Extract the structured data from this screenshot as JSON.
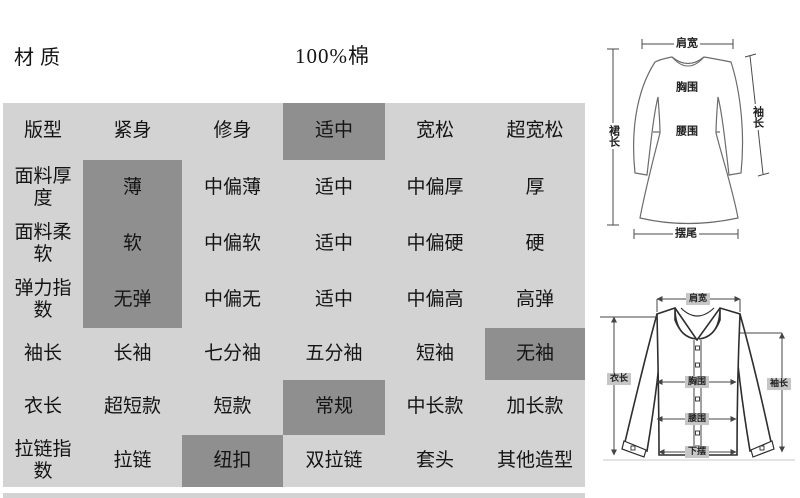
{
  "header": {
    "material_label": "材质",
    "material_value": "100%棉"
  },
  "colors": {
    "table_bg": "#d3d3d3",
    "selected_bg": "#8f8f8f",
    "text": "#141414",
    "chip_bg": "#c6c6c6"
  },
  "table": {
    "rows": [
      {
        "label": "版型",
        "options": [
          {
            "text": "紧身",
            "selected": false
          },
          {
            "text": "修身",
            "selected": false
          },
          {
            "text": "适中",
            "selected": true
          },
          {
            "text": "宽松",
            "selected": false
          },
          {
            "text": "超宽松",
            "selected": false
          }
        ]
      },
      {
        "label": "面料厚度",
        "options": [
          {
            "text": "薄",
            "selected": true
          },
          {
            "text": "中偏薄",
            "selected": false
          },
          {
            "text": "适中",
            "selected": false
          },
          {
            "text": "中偏厚",
            "selected": false
          },
          {
            "text": "厚",
            "selected": false
          }
        ]
      },
      {
        "label": "面料柔软",
        "options": [
          {
            "text": "软",
            "selected": true
          },
          {
            "text": "中偏软",
            "selected": false
          },
          {
            "text": "适中",
            "selected": false
          },
          {
            "text": "中偏硬",
            "selected": false
          },
          {
            "text": "硬",
            "selected": false
          }
        ]
      },
      {
        "label": "弹力指数",
        "options": [
          {
            "text": "无弹",
            "selected": true
          },
          {
            "text": "中偏无",
            "selected": false
          },
          {
            "text": "适中",
            "selected": false
          },
          {
            "text": "中偏高",
            "selected": false
          },
          {
            "text": "高弹",
            "selected": false
          }
        ]
      },
      {
        "label": "袖长",
        "options": [
          {
            "text": "长袖",
            "selected": false
          },
          {
            "text": "七分袖",
            "selected": false
          },
          {
            "text": "五分袖",
            "selected": false
          },
          {
            "text": "短袖",
            "selected": false
          },
          {
            "text": "无袖",
            "selected": true
          }
        ]
      },
      {
        "label": "衣长",
        "options": [
          {
            "text": "超短款",
            "selected": false
          },
          {
            "text": "短款",
            "selected": false
          },
          {
            "text": "常规",
            "selected": true
          },
          {
            "text": "中长款",
            "selected": false
          },
          {
            "text": "加长款",
            "selected": false
          }
        ]
      },
      {
        "label": "拉链指数",
        "options": [
          {
            "text": "拉链",
            "selected": false
          },
          {
            "text": "纽扣",
            "selected": true
          },
          {
            "text": "双拉链",
            "selected": false
          },
          {
            "text": "套头",
            "selected": false
          },
          {
            "text": "其他造型",
            "selected": false
          }
        ]
      }
    ]
  },
  "dress_diagram": {
    "labels": {
      "shoulder_width": "肩宽",
      "bust": "胸围",
      "waist": "腰围",
      "sleeve_length": "袖长",
      "skirt_length": "裙长",
      "hem": "摆尾"
    }
  },
  "shirt_diagram": {
    "labels": {
      "shoulder_width": "肩宽",
      "length": "衣长",
      "bust": "胸围",
      "waist": "腰围",
      "hem": "下摆",
      "sleeve_length": "袖长"
    }
  }
}
